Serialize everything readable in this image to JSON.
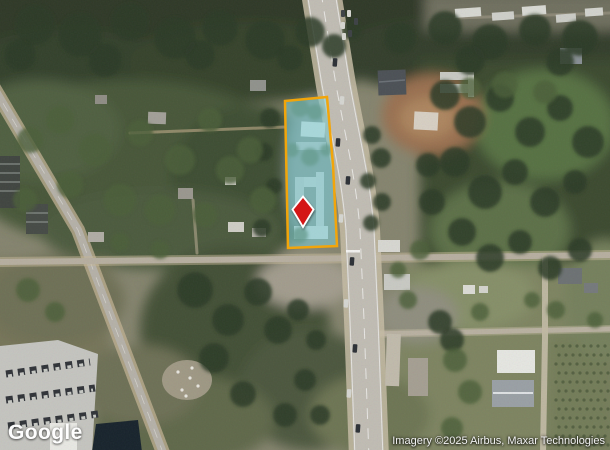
{
  "map": {
    "view_label": "satellite",
    "watermark": {
      "label": "Google"
    },
    "attribution": {
      "text": "Imagery ©2025 Airbus, Maxar Technologies"
    },
    "parcel": {
      "points": "285,101 327,97 333,165 337,246 288,248",
      "fill": "rgba(126,205,214,0.55)",
      "stroke": "#f2a50a",
      "stroke_width": "2.5"
    },
    "pin": {
      "path": "M303,196.5 L313.5,209.5 L303,227 L292.5,209.5 Z",
      "fill": "#d41217",
      "stroke": "#ffffff",
      "stroke_width": "1.8"
    }
  }
}
